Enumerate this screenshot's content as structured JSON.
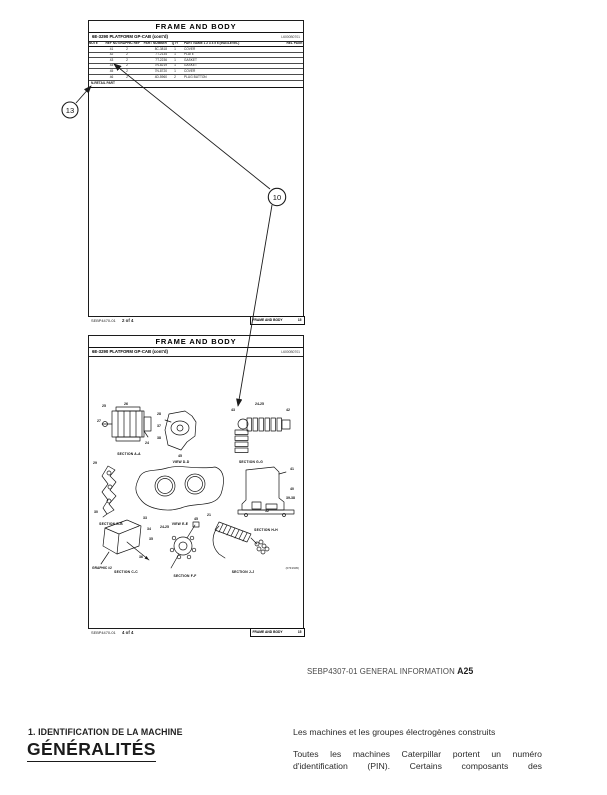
{
  "caption": {
    "ref": "SEBP4307-01 GENERAL INFORMATION",
    "page": "A25"
  },
  "annotations": {
    "ref13": "13",
    "ref10": "10"
  },
  "page1": {
    "title": "FRAME AND BODY",
    "subtitle": "6E-3290 PLATFORM GP-CAB (cont'd)",
    "doc_id": "L6000B0701",
    "columns": {
      "note": "NOTE",
      "ref": "REF NO",
      "graphic": "GRAPHIC REF",
      "part": "PART NUMBER",
      "qty": "QTY",
      "name": "PART NAME  1 2 3 4 5 6  (IND=LEVEL)",
      "rel": "REL PAGE"
    },
    "rows": [
      {
        "ref": "41",
        "graphic": "2",
        "part": "8C-3818",
        "qty": "1",
        "name": "COVER"
      },
      {
        "ref": "42",
        "graphic": "2",
        "part": "7T-2134",
        "qty": "1",
        "name": "PLATE"
      },
      {
        "ref": "43",
        "graphic": "2",
        "part": "7T-2236",
        "qty": "1",
        "name": "GASKET"
      },
      {
        "ref": "44",
        "graphic": "2",
        "part": "7N-8219",
        "qty": "1",
        "name": "GASKET"
      },
      {
        "ref": "45",
        "graphic": "2",
        "part": "7N-8720",
        "qty": "1",
        "name": "COVER"
      },
      {
        "ref": "46",
        "graphic": "2",
        "part": "4D-5960",
        "qty": "2",
        "name": "PLUG BUTTON"
      }
    ],
    "note_row": "N-RETAIL PART",
    "footer": {
      "doc": "SEBP4470-01",
      "sheet": "2 of 4",
      "section": "FRAME AND BODY",
      "page": "15"
    }
  },
  "page2": {
    "title": "FRAME AND BODY",
    "subtitle": "6E-3290 PLATFORM GP-CAB (cont'd)",
    "doc_id": "L6000B0701",
    "figures": [
      {
        "label": "SECTION A-A",
        "callouts": [
          "25",
          "26",
          "27",
          "24"
        ]
      },
      {
        "label": "VIEW D-D",
        "callouts": [
          "28",
          "37",
          "38"
        ]
      },
      {
        "label": "SECTION G-G",
        "callouts": [
          "43",
          "24-25",
          "42"
        ]
      },
      {
        "label": "SECTION B-B",
        "callouts": [
          "29",
          "30"
        ]
      },
      {
        "label": "VIEW E-E",
        "callouts": [
          "45"
        ]
      },
      {
        "label": "SECTION H-H",
        "callouts": [
          "41",
          "40",
          "39-38"
        ]
      },
      {
        "label": "SECTION C-C",
        "callouts": [
          "33",
          "34",
          "35",
          "36"
        ]
      },
      {
        "label": "SECTION F-F",
        "callouts": [
          "24-25",
          "45"
        ]
      },
      {
        "label": "SECTION J-J",
        "callouts": [
          "21",
          "52"
        ]
      }
    ],
    "graphic_label": "GRAPHIC #2",
    "photo_id": "(07F1945)",
    "footer": {
      "doc": "SEBP4470-01",
      "sheet": "4 of 4",
      "section": "FRAME AND BODY",
      "page": "15"
    }
  },
  "section": {
    "heading": "1. IDENTIFICATION DE LA MACHINE",
    "title": "GÉNÉRALITÉS",
    "intro": "Les machines et les groupes électrogènes construits",
    "para_line1": "Toutes les machines Caterpillar portent un numéro",
    "para_line2": "d'identification (PIN). Certains composants des"
  }
}
